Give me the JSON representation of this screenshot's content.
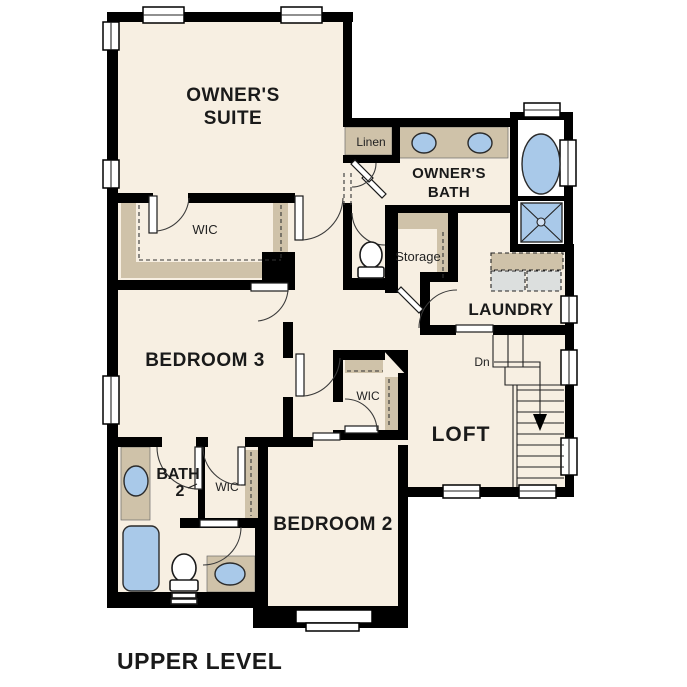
{
  "title": "UPPER LEVEL",
  "colors": {
    "background": "#ffffff",
    "floor": "#f7efe2",
    "wall": "#000000",
    "shelf_tan": "#cfc2a9",
    "fixture_blue": "#a9c9e9",
    "appliance_gray": "#dcdfde",
    "label_text": "#1a1a1a"
  },
  "rooms": {
    "owners_suite": {
      "line1": "OWNER'S",
      "line2": "SUITE"
    },
    "owners_bath": {
      "line1": "OWNER'S",
      "line2": "BATH"
    },
    "wic_owner": {
      "label": "WIC"
    },
    "linen": {
      "label": "Linen"
    },
    "storage": {
      "label": "Storage"
    },
    "laundry": {
      "label": "LAUNDRY"
    },
    "loft": {
      "label": "LOFT"
    },
    "bedroom3": {
      "label": "BEDROOM 3"
    },
    "bath2": {
      "line1": "BATH",
      "line2": "2"
    },
    "wic_bath2": {
      "label": "WIC"
    },
    "wic_bedroom2": {
      "label": "WIC"
    },
    "bedroom2": {
      "label": "BEDROOM 2"
    },
    "stairs": {
      "label": "Dn"
    }
  }
}
